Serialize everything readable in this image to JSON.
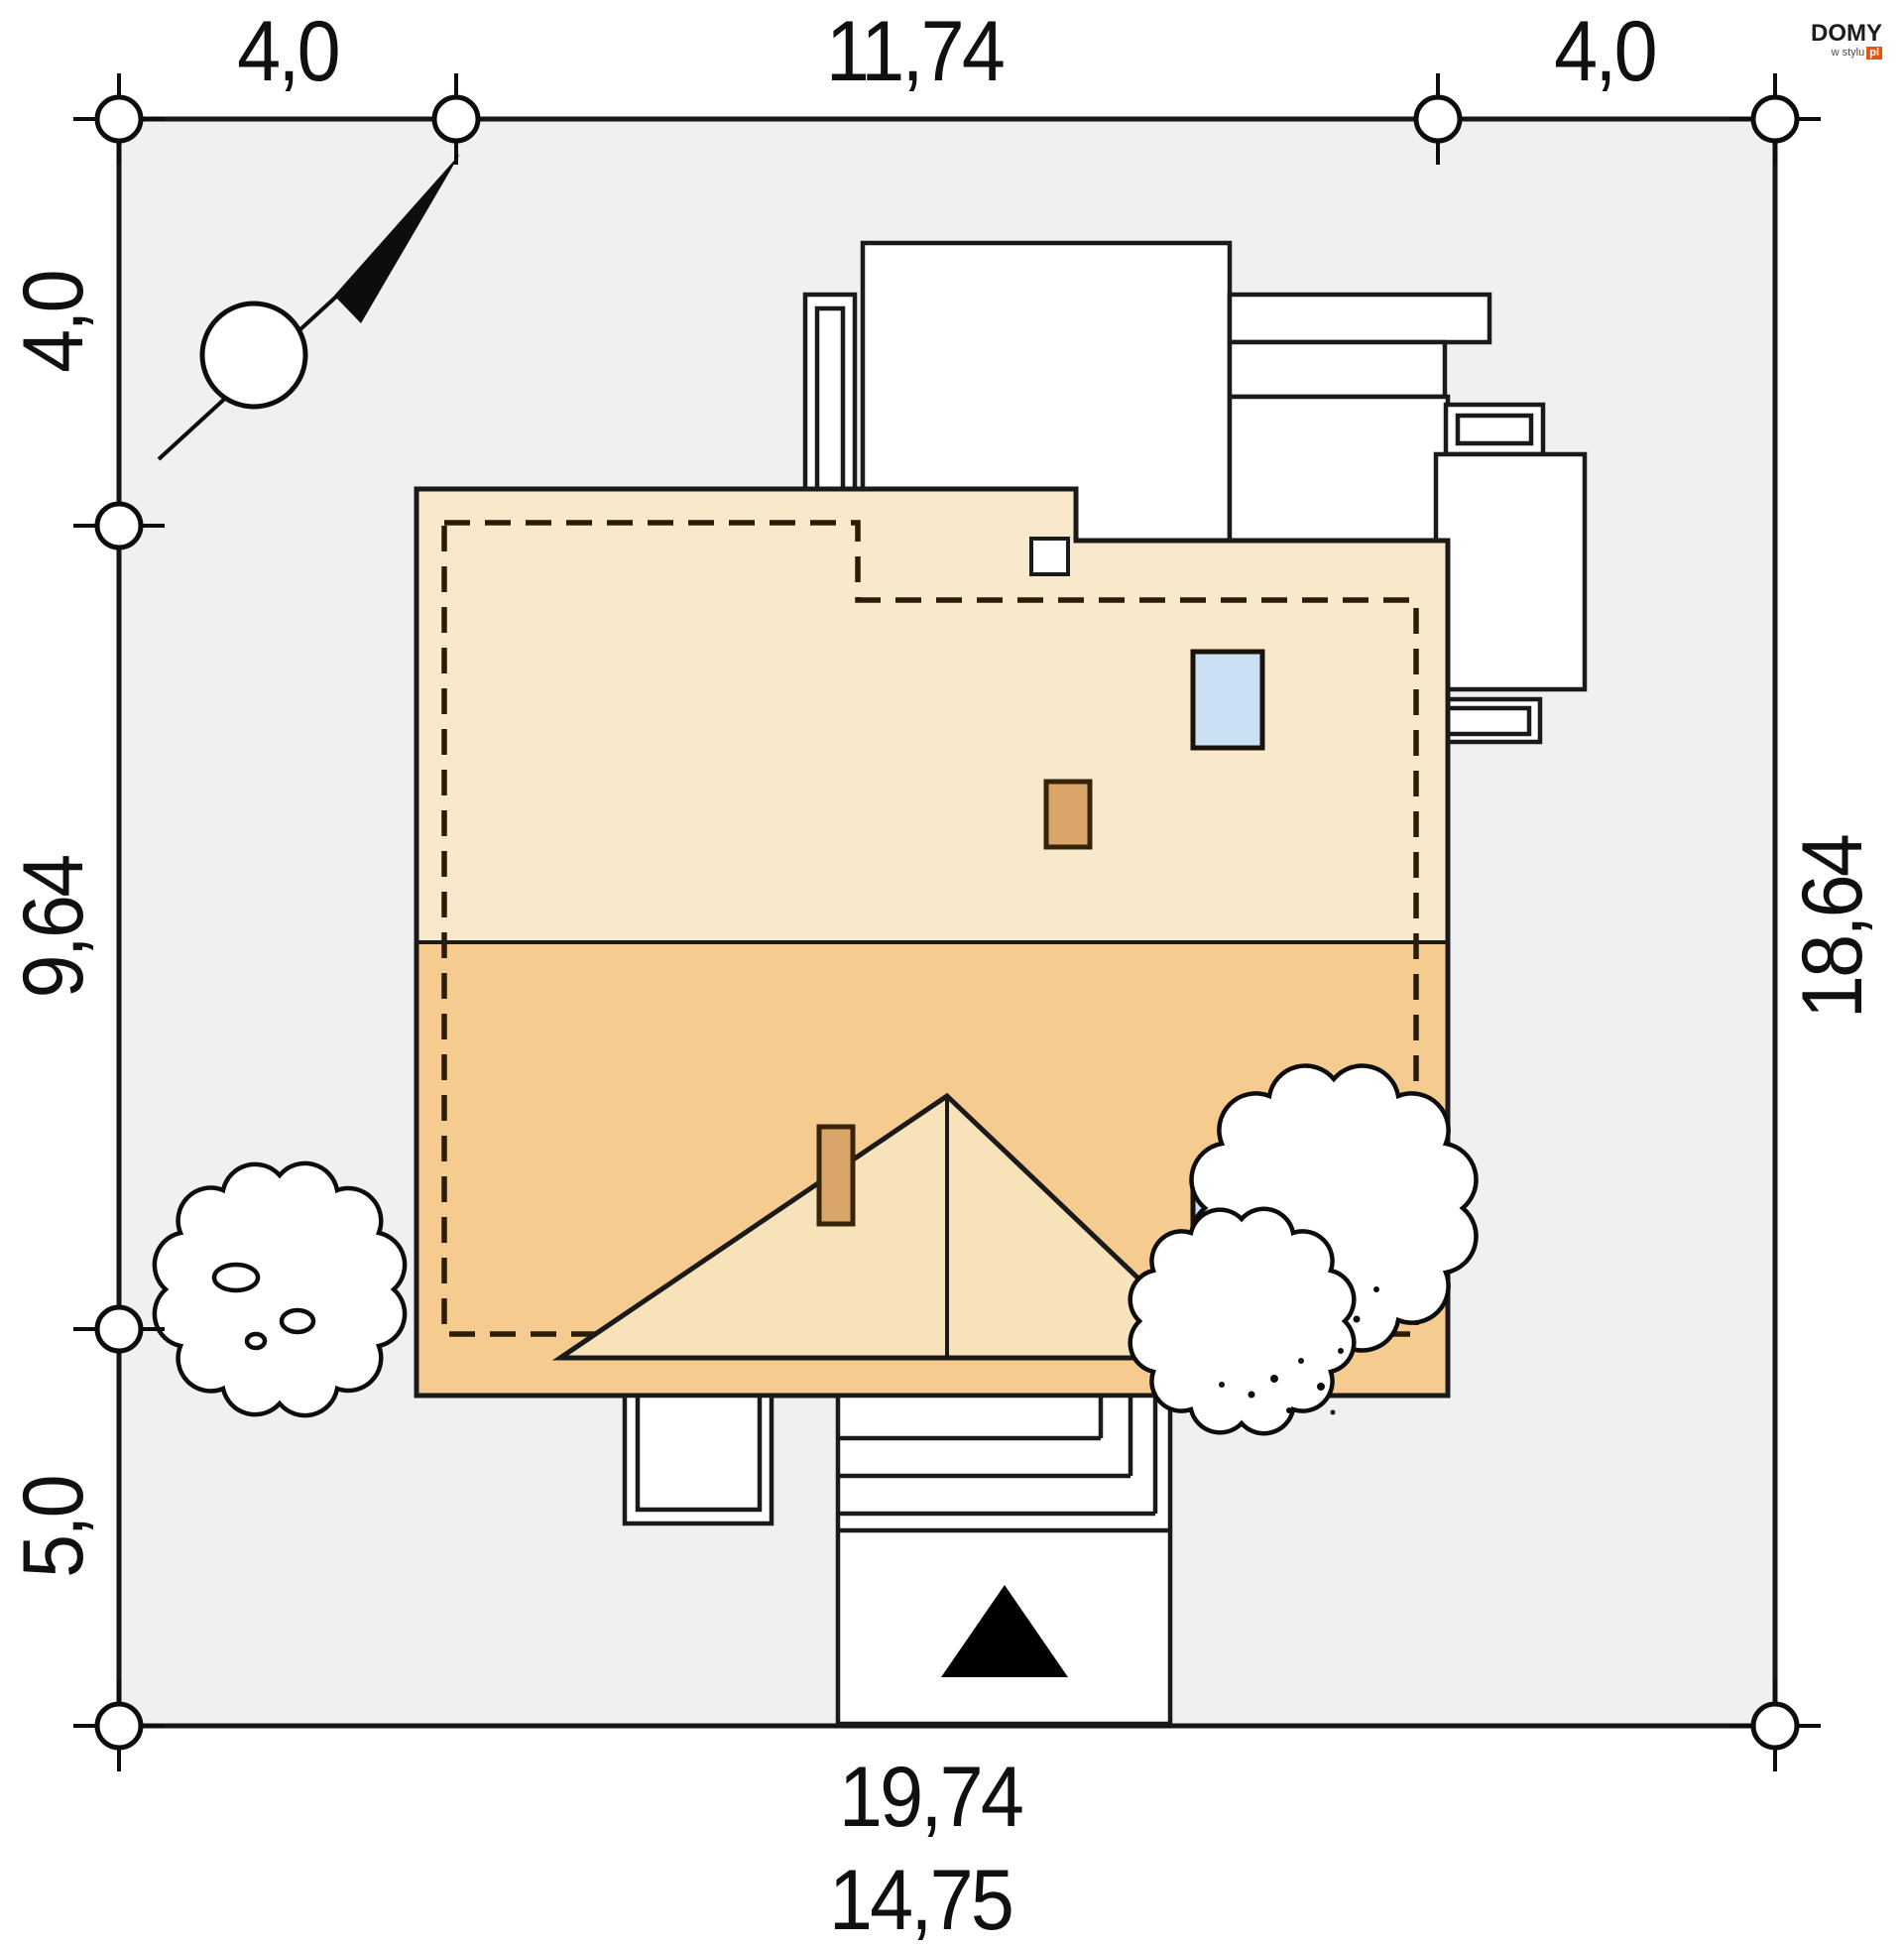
{
  "site_plan": {
    "title": "house site plan",
    "dims": {
      "top_left": "4,0",
      "top_center": "11,74",
      "top_right": "4,0",
      "left_top": "4,0",
      "left_middle": "9,64",
      "left_bottom": "5,0",
      "right_side": "18,64",
      "bottom_total": "19,74",
      "bottom_partial": "14,75"
    },
    "logo": {
      "brand": "DOMY",
      "tagline": "w stylu",
      "suffix": "pl"
    },
    "colors": {
      "plot": "#eef0f2",
      "line": "#161616",
      "roofUp": "#f9e9cc",
      "roofLo": "#f6cb90",
      "tri": "#f8e2ba",
      "chim": "#d9a568",
      "win": "#cbe0f4",
      "accent": "#e8530e",
      "page": "#ffffff"
    }
  }
}
